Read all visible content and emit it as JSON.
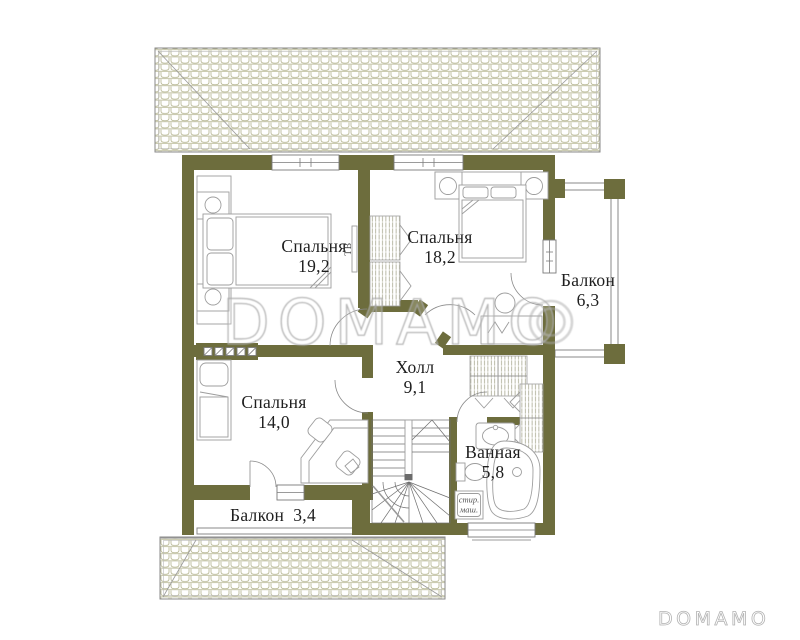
{
  "watermark": {
    "large": "DOMAMO",
    "small": "DOMAMO"
  },
  "rooms": [
    {
      "name": "Спальня",
      "area": "19,2"
    },
    {
      "name": "Спальня",
      "area": "18,2"
    },
    {
      "name": "Балкон",
      "area": "6,3"
    },
    {
      "name": "Холл",
      "area": "9,1"
    },
    {
      "name": "Спальня",
      "area": "14,0"
    },
    {
      "name": "Ванная",
      "area": "5,8"
    },
    {
      "name": "Балкон",
      "area": "3,4"
    }
  ],
  "annotations": {
    "tv": "ТВ",
    "washing_machine_line1": "стир.",
    "washing_machine_line2": "маш."
  },
  "colors": {
    "wall": "#6d6d3d",
    "roof_line": "#b3b38d",
    "furniture_line": "#9d9d9d",
    "window_line": "#7a7a7a",
    "stairs_line": "#6f6f6f",
    "text": "#1e1e1e",
    "watermark": "#aaaaaa"
  }
}
